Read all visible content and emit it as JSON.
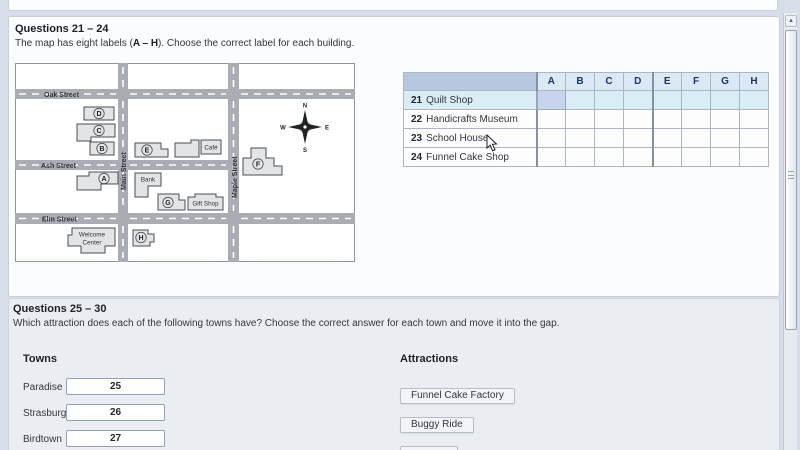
{
  "section_map": {
    "heading": "Questions 21 – 24",
    "instruction_pre": "The map has eight labels (",
    "instruction_bold": "A – H",
    "instruction_post": "). Choose the correct label for each building."
  },
  "map": {
    "streets": {
      "oak": "Oak Street",
      "ash": "Ash Street",
      "elm": "Elm Street",
      "main": "Main Street",
      "maple": "Maple Street"
    },
    "building_labels": [
      "A",
      "B",
      "C",
      "D",
      "E",
      "F",
      "G",
      "H"
    ],
    "places": {
      "cafe": "Café",
      "bank": "Bank",
      "gift_shop": "Gift Shop",
      "welcome_line1": "Welcome",
      "welcome_line2": "Center"
    },
    "compass": {
      "n": "N",
      "e": "E",
      "s": "S",
      "w": "W"
    }
  },
  "answer_table": {
    "columns": [
      "A",
      "B",
      "C",
      "D",
      "E",
      "F",
      "G",
      "H"
    ],
    "rows": [
      {
        "num": "21",
        "label": "Quilt Shop"
      },
      {
        "num": "22",
        "label": "Handicrafts Museum"
      },
      {
        "num": "23",
        "label": "School House"
      },
      {
        "num": "24",
        "label": "Funnel Cake Shop"
      }
    ],
    "selected_cell": "21-A"
  },
  "section_towns": {
    "heading": "Questions 25 – 30",
    "instruction": "Which attraction does each of the following towns have? Choose the correct answer for each town and move it into the gap.",
    "towns_heading": "Towns",
    "towns": [
      {
        "name": "Paradise",
        "gap": "25"
      },
      {
        "name": "Strasburg",
        "gap": "26"
      },
      {
        "name": "Birdtown",
        "gap": "27"
      }
    ],
    "attractions_heading": "Attractions",
    "attractions": [
      "Funnel Cake Factory",
      "Buggy Ride"
    ]
  },
  "colors": {
    "page_bg": "#d8dee9",
    "panel_bg": "#fbfcfe",
    "street_gray": "#a9adb3",
    "building_fill": "#e2e4e6",
    "table_header_corner": "#b5c8df",
    "table_header_bg": "#dbe8f5",
    "row_highlight": "#d9edf7",
    "selected_cell": "#c7d4ec"
  }
}
